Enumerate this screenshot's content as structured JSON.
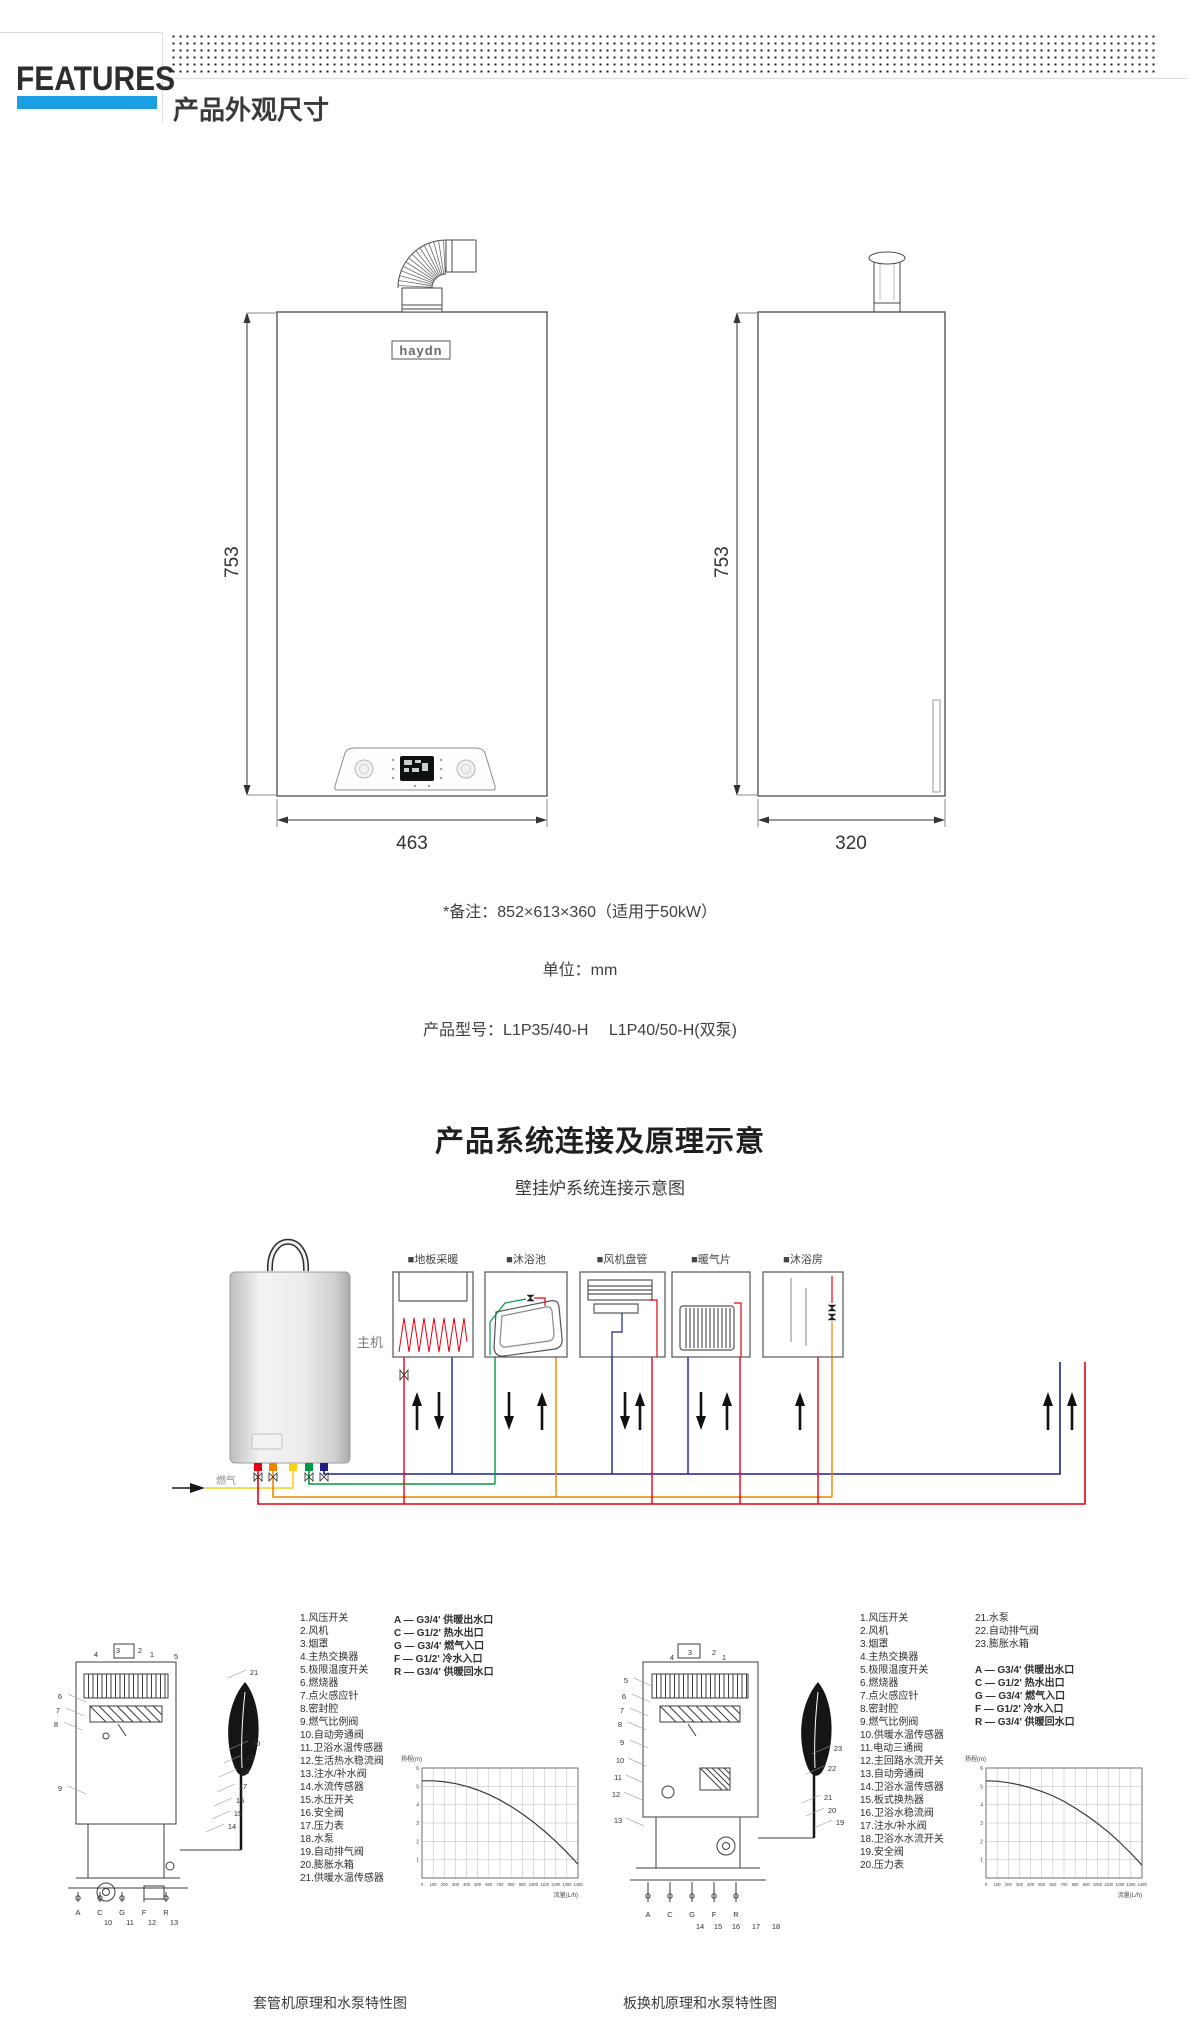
{
  "header": {
    "brand": "FEATURES",
    "title": "产品外观尺寸",
    "accent_color": "#1b9fe2"
  },
  "dimension_drawings": {
    "front": {
      "logo": "haydn",
      "height_label": "753",
      "width_label": "463"
    },
    "side": {
      "height_label": "753",
      "width_label": "320"
    }
  },
  "notes": {
    "remark": "*备注：852×613×360（适用于50kW）",
    "unit": "单位：mm",
    "models": "产品型号：L1P35/40-H　 L1P40/50-H(双泵)"
  },
  "system_section": {
    "title": "产品系统连接及原理示意",
    "subtitle": "壁挂炉系统连接示意图",
    "main_unit_label": "主机",
    "gas_label": "燃气",
    "terminals": [
      "■地板采暖",
      "■沐浴池",
      "■风机盘管",
      "■暖气片",
      "■沐浴房"
    ],
    "pipe_colors": {
      "red": "#e60012",
      "orange": "#f08300",
      "yellow": "#f7d117",
      "green": "#009944",
      "navy": "#1d2088"
    }
  },
  "left_diagram": {
    "parts": [
      "1.风压开关",
      "2.风机",
      "3.烟罩",
      "4.主热交换器",
      "5.极限温度开关",
      "6.燃烧器",
      "7.点火感应针",
      "8.密封腔",
      "9.燃气比例阀",
      "10.自动旁通阀",
      "11.卫浴水温传感器",
      "12.生活热水稳流阀",
      "13.注水/补水阀",
      "14.水流传感器",
      "15.水压开关",
      "16.安全阀",
      "17.压力表",
      "18.水泵",
      "19.自动排气阀",
      "20.膨胀水箱",
      "21.供暖水温传感器"
    ],
    "legend": [
      "A — G3/4' 供暖出水口",
      "C — G1/2' 热水出口",
      "G — G3/4' 燃气入口",
      "F — G1/2' 冷水入口",
      "R — G3/4' 供暖回水口"
    ],
    "callouts": [
      "1",
      "2",
      "3",
      "4",
      "5",
      "6",
      "7",
      "8",
      "9",
      "10",
      "11",
      "12",
      "13",
      "14",
      "15",
      "16",
      "17",
      "18",
      "19",
      "20",
      "21"
    ],
    "ports": [
      "A",
      "C",
      "G",
      "F",
      "R"
    ],
    "caption": "套管机原理和水泵特性图"
  },
  "right_diagram": {
    "parts": [
      "1.风压开关",
      "2.风机",
      "3.烟罩",
      "4.主热交换器",
      "5.极限温度开关",
      "6.燃烧器",
      "7.点火感应针",
      "8.密封腔",
      "9.燃气比例阀",
      "10.供暖水温传感器",
      "11.电动三通阀",
      "12.主回路水流开关",
      "13.自动旁通阀",
      "14.卫浴水温传感器",
      "15.板式换热器",
      "16.卫浴水稳流阀",
      "17.注水/补水阀",
      "18.卫浴水水流开关",
      "19.安全阀",
      "20.压力表"
    ],
    "parts2": [
      "21.水泵",
      "22.自动排气阀",
      "23.膨胀水箱"
    ],
    "legend": [
      "A — G3/4' 供暖出水口",
      "C — G1/2' 热水出口",
      "G — G3/4' 燃气入口",
      "F — G1/2' 冷水入口",
      "R — G3/4' 供暖回水口"
    ],
    "callouts": [
      "1",
      "2",
      "3",
      "4",
      "5",
      "6",
      "7",
      "8",
      "9",
      "10",
      "11",
      "12",
      "13",
      "14",
      "15",
      "16",
      "17",
      "18",
      "19",
      "20",
      "21",
      "22",
      "23"
    ],
    "ports": [
      "A",
      "C",
      "G",
      "F",
      "R"
    ],
    "caption": "板换机原理和水泵特性图"
  },
  "chart_data": [
    {
      "type": "line",
      "corner_label": "扬程(m)",
      "xlabel": "流量(L/h)",
      "x": [
        0,
        100,
        200,
        300,
        400,
        500,
        600,
        700,
        800,
        900,
        1000,
        1100,
        1200,
        1300,
        1400
      ],
      "series": [
        {
          "name": "pump-curve",
          "values": [
            5.3,
            5.3,
            5.25,
            5.15,
            5.0,
            4.8,
            4.55,
            4.25,
            3.9,
            3.5,
            3.05,
            2.55,
            2.0,
            1.4,
            0.75
          ]
        }
      ],
      "ylim": [
        0,
        6
      ],
      "yticks": [
        1,
        2,
        3,
        4,
        5,
        6
      ],
      "grid": true,
      "legend_position": "none"
    },
    {
      "type": "line",
      "corner_label": "扬程(m)",
      "xlabel": "流量(L/h)",
      "x": [
        0,
        100,
        200,
        300,
        400,
        500,
        600,
        700,
        800,
        900,
        1000,
        1100,
        1200,
        1300,
        1400
      ],
      "series": [
        {
          "name": "pump-curve",
          "values": [
            5.3,
            5.28,
            5.2,
            5.08,
            4.92,
            4.72,
            4.48,
            4.18,
            3.82,
            3.42,
            2.98,
            2.5,
            1.95,
            1.35,
            0.7
          ]
        }
      ],
      "ylim": [
        0,
        6
      ],
      "yticks": [
        1,
        2,
        3,
        4,
        5,
        6
      ],
      "grid": true,
      "legend_position": "none"
    }
  ]
}
